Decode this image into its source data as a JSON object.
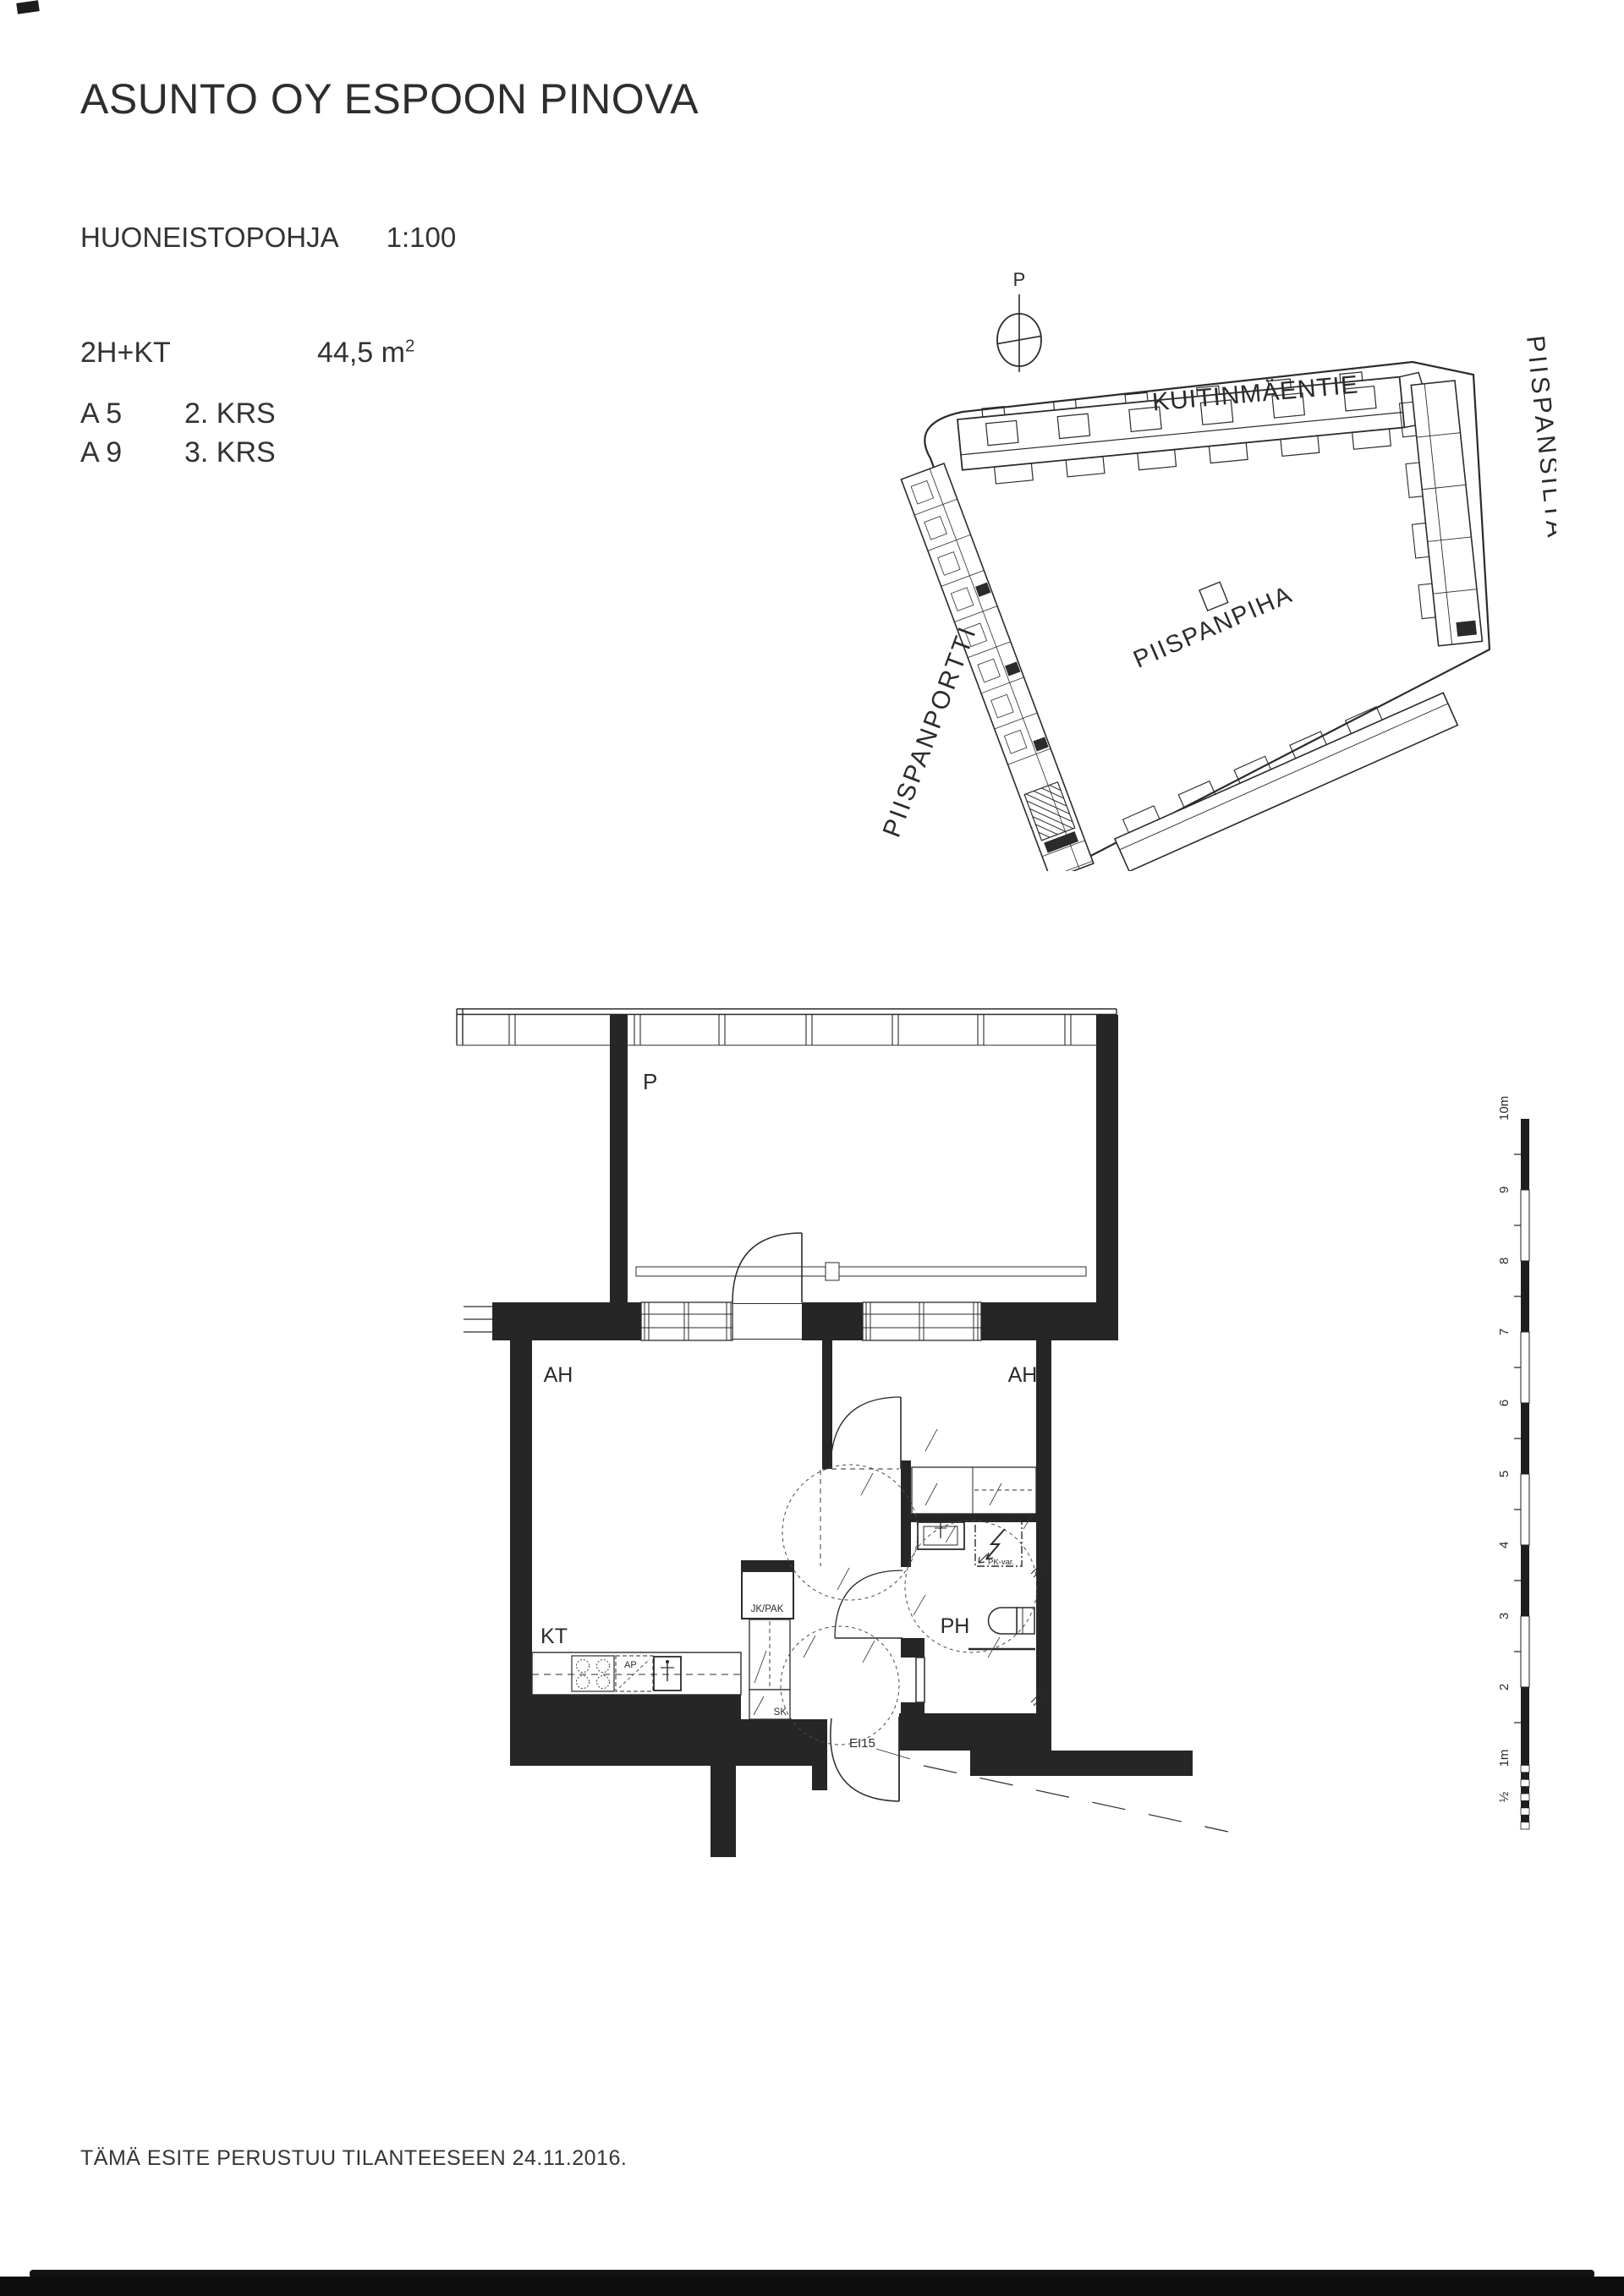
{
  "page": {
    "background": "#ffffff",
    "ink": "#2b2b2b"
  },
  "header": {
    "title": "ASUNTO OY ESPOON PINOVA",
    "plan_type": "HUONEISTOPOHJA",
    "scale": "1:100",
    "apartment_type": "2H+KT",
    "area_value": "44,5 m",
    "area_sup": "2",
    "units": [
      {
        "id": "A 5",
        "floor": "2. KRS"
      },
      {
        "id": "A 9",
        "floor": "3. KRS"
      }
    ]
  },
  "site_plan": {
    "north_label": "P",
    "streets": {
      "north": "KUITINMÄENTIE",
      "east": "PIISPANSILTA",
      "west": "PIISPANPORTTI",
      "south": "PIISPANPIHA"
    }
  },
  "floor_plan": {
    "balcony_label": "P",
    "room_left": "AH",
    "room_right": "AH",
    "kitchen": "KT",
    "bathroom": "PH",
    "fridge_freezer": "JK/PAK",
    "cleaning_closet": "SK",
    "dishwasher": "AP",
    "washer_reservation": "PK-var.",
    "entry_door_rating": "EI15"
  },
  "scale_bar": {
    "labels": [
      "10m",
      "9",
      "8",
      "7",
      "6",
      "5",
      "4",
      "3",
      "2",
      "1m",
      "½"
    ]
  },
  "footer": {
    "note": "TÄMÄ ESITE PERUSTUU TILANTEESEEN 24.11.2016."
  }
}
